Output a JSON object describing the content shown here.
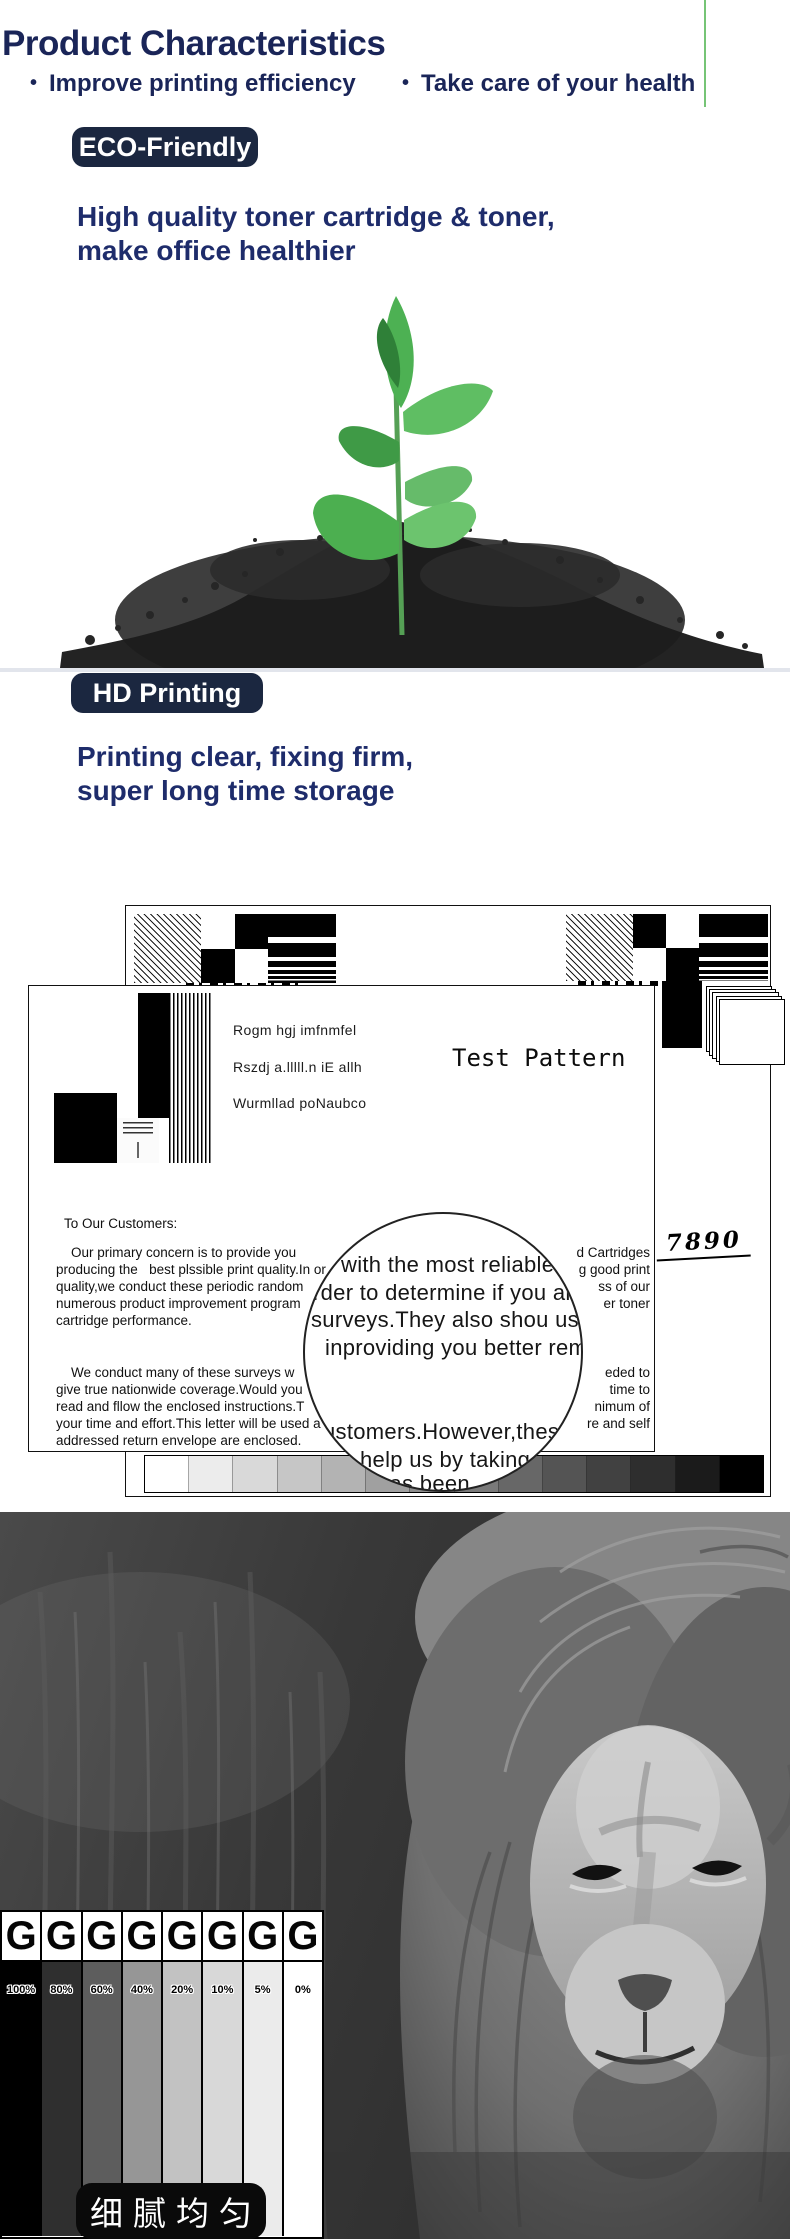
{
  "header": {
    "title": "Product Characteristics",
    "bullet1": "Improve printing efficiency",
    "bullet2": "Take care of your health",
    "text_color": "#1a2558",
    "green_line_color": "#76c476"
  },
  "eco_section": {
    "badge": "ECO-Friendly",
    "badge_bg": "#1b2740",
    "heading_line1": "High quality toner cartridge & toner,",
    "heading_line2": "make office healthier"
  },
  "hd_section": {
    "badge": "HD Printing",
    "heading_line1": "Printing clear, fixing firm,",
    "heading_line2": "super long time storage"
  },
  "test_pattern": {
    "title": "Test Pattern",
    "sample_lines": [
      "Rogm hgj imfnmfel",
      "Rszdj a.lllll.n iE allh",
      "Wurmllad poNaubco"
    ],
    "salutation": "To Our Customers:",
    "handwritten": "7890",
    "paragraph1": [
      {
        "left": "Our primary concern is to provide you",
        "right": "d Cartridges"
      },
      {
        "left": "producing the   best plssible print quality.In or",
        "right": "g good print"
      },
      {
        "left": "quality,we conduct these periodic random",
        "right": "ss of our"
      },
      {
        "left": "numerous product improvement program",
        "right": "er toner"
      },
      {
        "left": "cartridge performance.",
        "right": ""
      }
    ],
    "paragraph2": [
      {
        "left": "We conduct many of these surveys w",
        "right": "eded to"
      },
      {
        "left": "give true nationwide coverage.Would you",
        "right": "time to"
      },
      {
        "left": "read and fllow the enclosed instructions.T",
        "right": "nimum of"
      },
      {
        "left": "your time and effort.This letter will be used a",
        "right": "re and self"
      },
      {
        "left": "addressed return envelope are enclosed.",
        "right": ""
      }
    ],
    "magnifier_lines": [
      "with the most reliable",
      "rder to determine if you are",
      "surveys.They also shou us t",
      "inproviding you better rema",
      "ustomers.However,these",
      "help us by taking a",
      "has been"
    ],
    "grayscale_steps": [
      "#ffffff",
      "#ececec",
      "#d9d9d9",
      "#c6c6c6",
      "#b3b3b3",
      "#a0a0a0",
      "#8d8d8d",
      "#7a7a7a",
      "#676767",
      "#545454",
      "#414141",
      "#2e2e2e",
      "#1b1b1b",
      "#000000"
    ]
  },
  "density_chart": {
    "letter": "G",
    "columns": [
      {
        "label": "100%",
        "color": "#000000"
      },
      {
        "label": "80%",
        "color": "#2f2f2f"
      },
      {
        "label": "60%",
        "color": "#5d5d5d"
      },
      {
        "label": "40%",
        "color": "#969696"
      },
      {
        "label": "20%",
        "color": "#c2c2c2"
      },
      {
        "label": "10%",
        "color": "#d8d8d8"
      },
      {
        "label": "5%",
        "color": "#ebebeb"
      },
      {
        "label": "0%",
        "color": "#ffffff"
      }
    ],
    "caption": "细腻均匀",
    "caption_bg": "#0a0a0a"
  }
}
